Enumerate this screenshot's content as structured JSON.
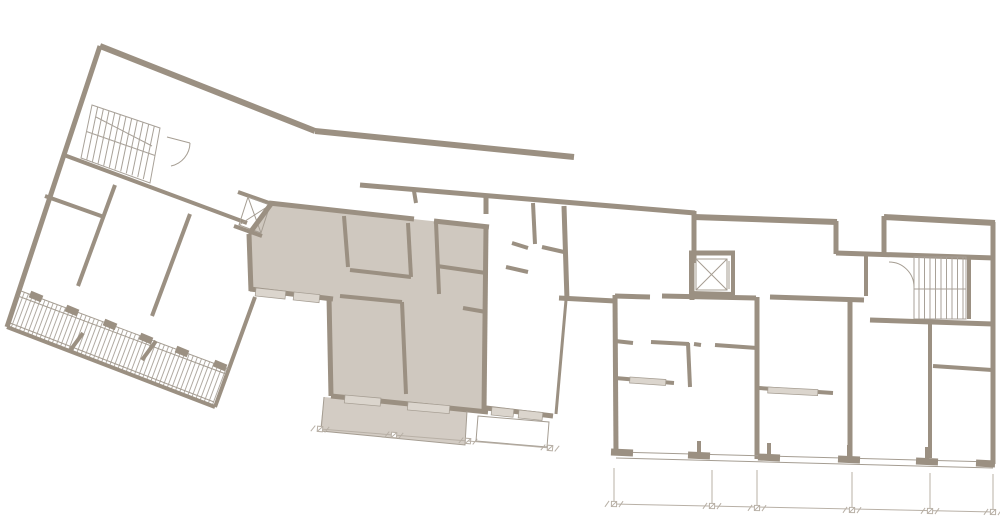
{
  "plan": {
    "type": "architectural-floor-plan",
    "highlighted_unit": {
      "name": "highlighted-apartment-unit",
      "state": "selected",
      "rooms_visible": 5,
      "has_terrace": true
    },
    "features": [
      "west-wing-rotated",
      "west-staircase",
      "west-elevator",
      "west-balcony-band-hatched",
      "central-highlighted-unit",
      "central-terrace",
      "middle-apartment",
      "middle-balcony",
      "east-wing",
      "east-corridor",
      "east-elevator",
      "east-staircase",
      "east-apartment-row",
      "dimension-chains"
    ],
    "icons": {
      "elevator": "box-with-x-cross",
      "stairs": "parallel-tread-lines",
      "door": "quarter-arc-swing",
      "dimension_marker": "crossed-square-with-slashes"
    }
  },
  "colors": {
    "wall": "#9b9082",
    "unit": "#cfc8bf",
    "terrace": "#d3ccc4",
    "window": "#dbd5cd",
    "thin": "#a59d92",
    "stair": "#a8a198",
    "dim": "#b8b0a6",
    "bg": "#ffffff"
  }
}
